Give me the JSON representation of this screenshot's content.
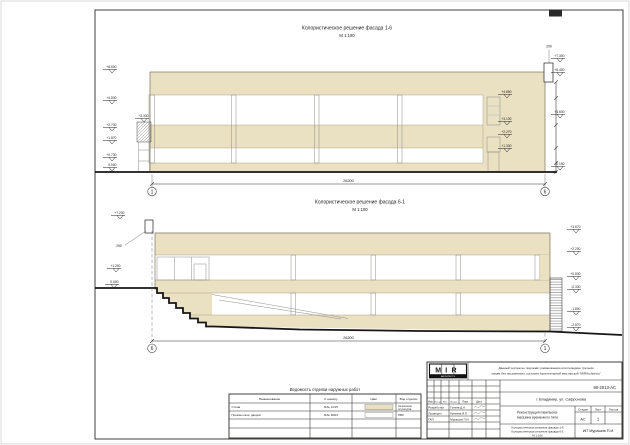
{
  "sheet": {
    "titleblock": {
      "disclaimer_line1": "Данный чертеж не подлежит размножению или передаче третьим",
      "disclaimer_line2": "лицам без письменного согласия Архитектурной мастерской \"MIRArchitects\"",
      "code": "90-2013-АС",
      "address": "г. Владимир, ул. Сафронова",
      "project_line1": "Реконструкция павильона-",
      "project_line2": "магазина временного типа",
      "doc_title_line1": "Колористическое решение фасада 1-6",
      "doc_title_line2": "Колористическое решение фасада 6-1",
      "doc_scale": "М 1:100",
      "firm": "ИП Мурашов П.И.",
      "stage_label": "Стадия",
      "sheet_label": "Лист",
      "sheets_label": "Листов",
      "stage": "АС",
      "sheet_no": "1",
      "logo": {
        "text": "MIR",
        "sub": "ARCHITECTS"
      },
      "sig_cols": [
        "Изм.",
        "Кол.уч",
        "Лист",
        "№ док.",
        "Подп.",
        "Дата"
      ],
      "sig_rows": [
        {
          "role": "Разработал",
          "name": "Гунеев Д.А."
        },
        {
          "role": "Проверил",
          "name": "Кунеева И.П."
        },
        {
          "role": "ГАП",
          "name": "Мурашов П.И."
        }
      ]
    },
    "colors": {
      "wall": "#EAE0C2",
      "concrete": "#B5B6AE",
      "glass": "#8BA0B0",
      "line": "#2B2B28"
    }
  },
  "top_elevation": {
    "title": "Колористическое решение фасада 1-6",
    "scale": "М 1:100",
    "axis_left": "1",
    "axis_right": "6",
    "total_dim": "26200",
    "marks": {
      "left": [
        "+6.600",
        "+4.530",
        "+2.730",
        "+1.870",
        "+0.730",
        "0.000"
      ],
      "wall": [
        "+4.850",
        "+3.130",
        "+2.270",
        "+1.330"
      ],
      "chain": [
        "+7.300",
        "+6.400",
        "+3.600",
        "-0.150"
      ],
      "stair": "+3.330",
      "pipe_width": "290"
    }
  },
  "bottom_elevation": {
    "title": "Колористическое решение фасада 6-1",
    "scale": "М 1:100",
    "axis_left": "6",
    "axis_right": "1",
    "total_dim": "26200",
    "marks": {
      "left": [
        "+7.200",
        "+1.200",
        "0.000"
      ],
      "right": [
        "+3.670",
        "+2.200",
        "+0.530",
        "-0.330",
        "-1.800",
        "-2.870"
      ],
      "pipe_width": "290"
    }
  },
  "finish_table": {
    "title": "Ведомость отделки наружных работ",
    "headers": [
      "Наименование",
      "К номеру",
      "Цвет",
      "Вид отделки"
    ],
    "rows": [
      {
        "name": "Стена",
        "number": "RAL 1015",
        "swatch": "#EAE0C2",
        "finish_line1": "Силикатная",
        "finish_line2": "штукатурка"
      },
      {
        "name": "Проемы окон, дверей",
        "number": "RAL 9003",
        "swatch": "#FFFFFF",
        "finish_line1": "ПВХ",
        "finish_line2": ""
      }
    ]
  }
}
